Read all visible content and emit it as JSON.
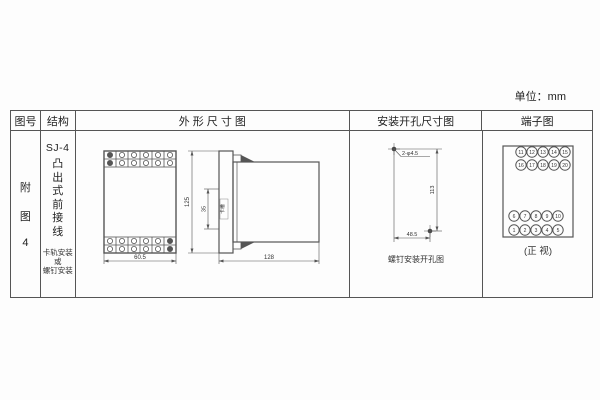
{
  "unit_label": "单位：mm",
  "headers": {
    "fig_no": "图号",
    "structure": "结构",
    "outline": "外 形 尺 寸 图",
    "mounting": "安装开孔尺寸图",
    "terminal": "端子图"
  },
  "fig_no": {
    "char1": "附",
    "char2": "图",
    "char3": "4"
  },
  "structure": {
    "model": "SJ-4",
    "type_vertical": "凸出式前接线",
    "note_line1": "卡轨安装",
    "note_line2": "或",
    "note_line3": "螺钉安装"
  },
  "outline": {
    "front_width_dim": "60.5",
    "side_height_dim": "125",
    "slot_dim": "35",
    "slot_label": "卡槽",
    "side_depth_dim": "128"
  },
  "mounting": {
    "holes_label": "2-φ4.5",
    "height_dim": "113",
    "width_dim": "48.5",
    "caption": "螺钉安装开孔图"
  },
  "terminal": {
    "top_rows": [
      [
        "11",
        "12",
        "13",
        "14",
        "15"
      ],
      [
        "16",
        "17",
        "18",
        "19",
        "20"
      ]
    ],
    "bottom_rows": [
      [
        "6",
        "7",
        "8",
        "9",
        "10"
      ],
      [
        "1",
        "2",
        "3",
        "4",
        "5"
      ]
    ],
    "caption": "(正 视)"
  },
  "colors": {
    "line": "#555",
    "ink": "#333",
    "bg": "#fdfdfd"
  }
}
